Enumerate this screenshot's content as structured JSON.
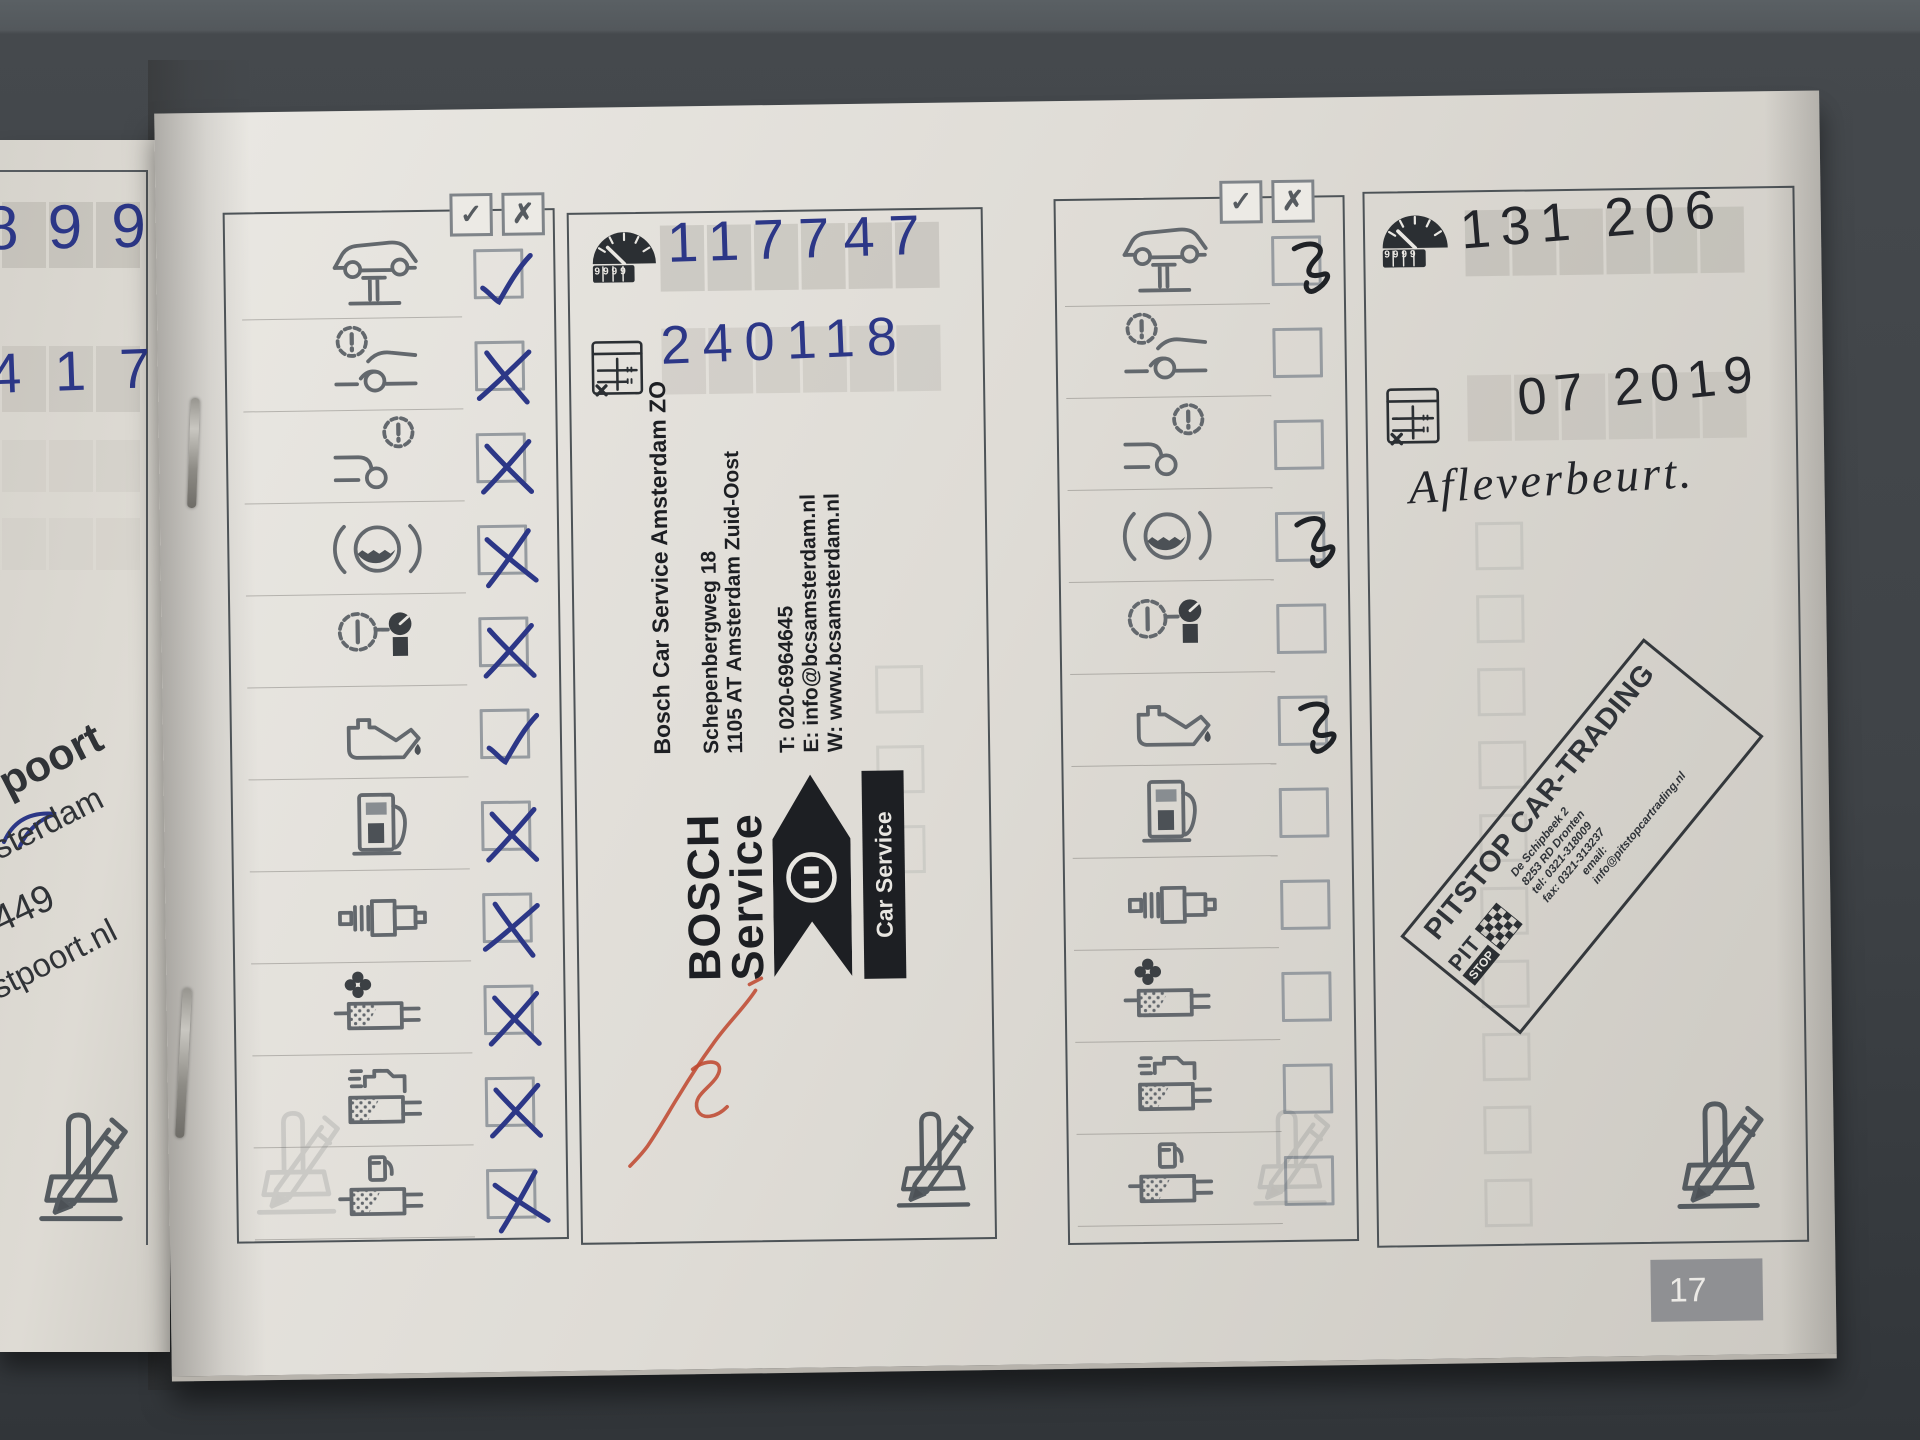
{
  "page_number": "17",
  "header_marks": {
    "check": "✓",
    "cross": "✗"
  },
  "left_page": {
    "odometer_fragment": "8 9 9",
    "date_fragment": "4  1 7",
    "stamp_fragments": {
      "f1": "poort",
      "f2": "sterdam",
      "f3": "449",
      "f4": "stpoort.nl"
    }
  },
  "service_items": [
    {
      "icon": "vehicle-on-lift-icon"
    },
    {
      "icon": "front-brakes-warning-icon"
    },
    {
      "icon": "rear-brakes-warning-icon"
    },
    {
      "icon": "brake-fluid-icon"
    },
    {
      "icon": "tire-pressure-gauge-icon"
    },
    {
      "icon": "engine-oil-can-icon"
    },
    {
      "icon": "fuel-pump-icon"
    },
    {
      "icon": "spark-plug-icon"
    },
    {
      "icon": "air-filter-icon"
    },
    {
      "icon": "engine-interior-filter-icon"
    },
    {
      "icon": "fuel-filter-icon"
    }
  ],
  "column1": {
    "marks": [
      "check",
      "cross",
      "cross",
      "cross",
      "cross",
      "check",
      "cross",
      "cross",
      "cross",
      "cross",
      "cross"
    ]
  },
  "column2": {
    "odometer": "117747",
    "date": "240118",
    "odometer_icon_digits": "9999",
    "stamp": {
      "name": "Bosch Car Service Amsterdam ZO",
      "street": "Schepenbergweg 18",
      "city": "1105 AT Amsterdam Zuid-Oost",
      "phone": "T: 020-6964645",
      "email": "E: info@bcsamsterdam.nl",
      "web": "W: www.bcsamsterdam.nl",
      "logo_word1": "BOSCH",
      "logo_word2": "Service",
      "logo_bar": "Car Service"
    }
  },
  "column3": {
    "marks": [
      "scribble",
      "none",
      "none",
      "scribble",
      "none",
      "scribble",
      "none",
      "none",
      "none",
      "none",
      "none"
    ]
  },
  "column4": {
    "odometer": "131 206",
    "date": "07 2019",
    "odometer_icon_digits": "9999",
    "note": "Afleverbeurt.",
    "stamp": {
      "title": "PITSTOP CAR-TRADING",
      "line1": "De Schipbeek 2",
      "line2": "8253 RD Dronten",
      "line3": "tel: 0321-318009",
      "line4": "fax: 0321-313237",
      "line5": "email:",
      "line6": "info@pitstopcartrading.nl",
      "logo_top": "PIT",
      "logo_bottom": "STOP"
    }
  },
  "colors": {
    "ink_blue": "#2c3787",
    "ink_black": "#23252a",
    "signature_red": "#bf4a32"
  }
}
